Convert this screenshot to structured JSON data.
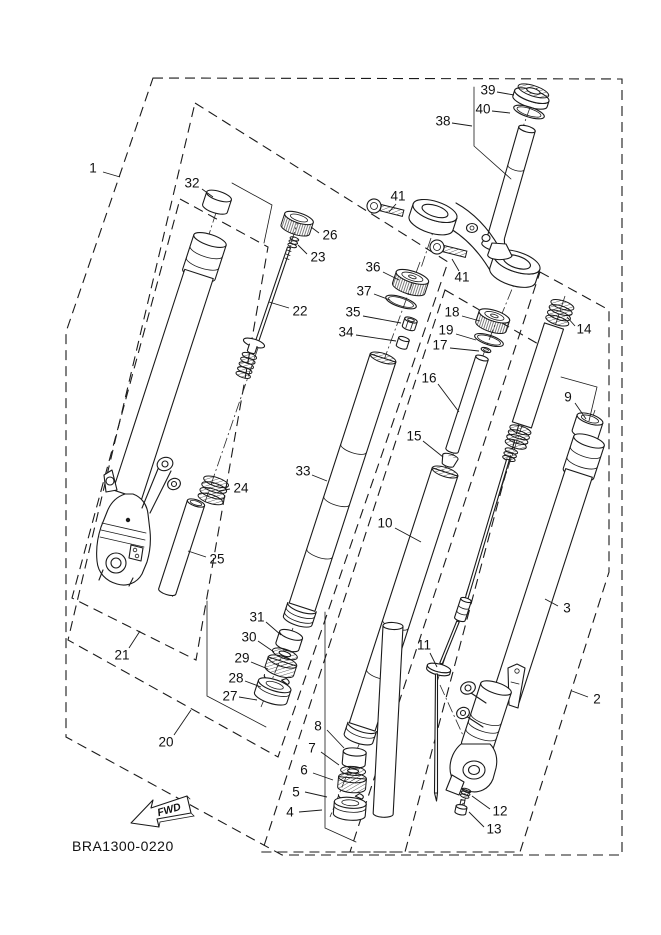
{
  "diagram": {
    "code": "BRA1300-0220",
    "fwd_label": "FWD"
  },
  "colors": {
    "line": "#1a1a1a",
    "background": "#ffffff"
  },
  "callouts": [
    {
      "label": "1",
      "x": 93,
      "y": 169,
      "leader": [
        103,
        172,
        120,
        177
      ]
    },
    {
      "label": "32",
      "x": 192,
      "y": 184,
      "leader": [
        202,
        189,
        213,
        197
      ]
    },
    {
      "label": "26",
      "x": 330,
      "y": 236,
      "leader": [
        319,
        233,
        311,
        227
      ]
    },
    {
      "label": "23",
      "x": 318,
      "y": 258,
      "leader": [
        307,
        254,
        298,
        245
      ]
    },
    {
      "label": "22",
      "x": 300,
      "y": 312,
      "leader": [
        289,
        308,
        269,
        302
      ]
    },
    {
      "label": "24",
      "x": 241,
      "y": 489,
      "leader": [
        230,
        489,
        219,
        491
      ]
    },
    {
      "label": "25",
      "x": 217,
      "y": 560,
      "leader": [
        206,
        557,
        188,
        551
      ]
    },
    {
      "label": "21",
      "x": 122,
      "y": 656,
      "leader": [
        129,
        648,
        140,
        631
      ]
    },
    {
      "label": "20",
      "x": 166,
      "y": 743,
      "leader": [
        174,
        735,
        191,
        710
      ]
    },
    {
      "label": "31",
      "x": 257,
      "y": 618,
      "leader": [
        266,
        622,
        281,
        635
      ]
    },
    {
      "label": "30",
      "x": 249,
      "y": 638,
      "leader": [
        258,
        641,
        274,
        652
      ]
    },
    {
      "label": "29",
      "x": 242,
      "y": 659,
      "leader": [
        251,
        662,
        268,
        669
      ]
    },
    {
      "label": "28",
      "x": 236,
      "y": 679,
      "leader": [
        245,
        681,
        261,
        687
      ]
    },
    {
      "label": "27",
      "x": 230,
      "y": 697,
      "leader": [
        239,
        697,
        257,
        700
      ]
    },
    {
      "label": "33",
      "x": 303,
      "y": 472,
      "leader": [
        312,
        475,
        327,
        481
      ]
    },
    {
      "label": "36",
      "x": 373,
      "y": 268,
      "leader": [
        383,
        272,
        399,
        280
      ]
    },
    {
      "label": "37",
      "x": 364,
      "y": 292,
      "leader": [
        374,
        294,
        390,
        300
      ]
    },
    {
      "label": "35",
      "x": 353,
      "y": 313,
      "leader": [
        363,
        316,
        401,
        323
      ]
    },
    {
      "label": "34",
      "x": 346,
      "y": 333,
      "leader": [
        356,
        335,
        396,
        341
      ]
    },
    {
      "label": "38",
      "x": 443,
      "y": 122,
      "leader": [
        452,
        123,
        472,
        126
      ]
    },
    {
      "label": "39",
      "x": 488,
      "y": 91,
      "leader": [
        497,
        92,
        514,
        95
      ]
    },
    {
      "label": "40",
      "x": 483,
      "y": 110,
      "leader": [
        492,
        111,
        510,
        113
      ]
    },
    {
      "label": "41",
      "x": 398,
      "y": 197,
      "leader": [
        396,
        204,
        389,
        212
      ]
    },
    {
      "label": "41",
      "x": 462,
      "y": 278,
      "leader": [
        459,
        271,
        452,
        259
      ]
    },
    {
      "label": "18",
      "x": 452,
      "y": 313,
      "leader": [
        462,
        316,
        480,
        321
      ]
    },
    {
      "label": "19",
      "x": 446,
      "y": 331,
      "leader": [
        456,
        334,
        476,
        340
      ]
    },
    {
      "label": "17",
      "x": 440,
      "y": 346,
      "leader": [
        450,
        348,
        479,
        351
      ]
    },
    {
      "label": "16",
      "x": 429,
      "y": 379,
      "leader": [
        438,
        384,
        459,
        412
      ]
    },
    {
      "label": "15",
      "x": 414,
      "y": 437,
      "leader": [
        423,
        441,
        443,
        457
      ]
    },
    {
      "label": "14",
      "x": 584,
      "y": 330,
      "leader": [
        575,
        326,
        567,
        317
      ]
    },
    {
      "label": "9",
      "x": 568,
      "y": 398,
      "leader": [
        575,
        403,
        586,
        419
      ]
    },
    {
      "label": "10",
      "x": 385,
      "y": 524,
      "leader": [
        395,
        528,
        421,
        542
      ]
    },
    {
      "label": "3",
      "x": 567,
      "y": 609,
      "leader": [
        558,
        606,
        545,
        599
      ]
    },
    {
      "label": "2",
      "x": 597,
      "y": 700,
      "leader": [
        588,
        697,
        572,
        691
      ]
    },
    {
      "label": "11",
      "x": 424,
      "y": 646,
      "leader": [
        430,
        653,
        437,
        667
      ]
    },
    {
      "label": "8",
      "x": 318,
      "y": 727,
      "leader": [
        327,
        730,
        344,
        748
      ]
    },
    {
      "label": "7",
      "x": 312,
      "y": 749,
      "leader": [
        321,
        752,
        339,
        765
      ]
    },
    {
      "label": "6",
      "x": 304,
      "y": 771,
      "leader": [
        313,
        773,
        333,
        780
      ]
    },
    {
      "label": "5",
      "x": 296,
      "y": 793,
      "leader": [
        305,
        792,
        327,
        797
      ]
    },
    {
      "label": "4",
      "x": 290,
      "y": 813,
      "leader": [
        299,
        812,
        322,
        810
      ]
    },
    {
      "label": "12",
      "x": 500,
      "y": 812,
      "leader": [
        490,
        809,
        472,
        796
      ]
    },
    {
      "label": "13",
      "x": 494,
      "y": 830,
      "leader": [
        484,
        827,
        469,
        812
      ]
    }
  ]
}
